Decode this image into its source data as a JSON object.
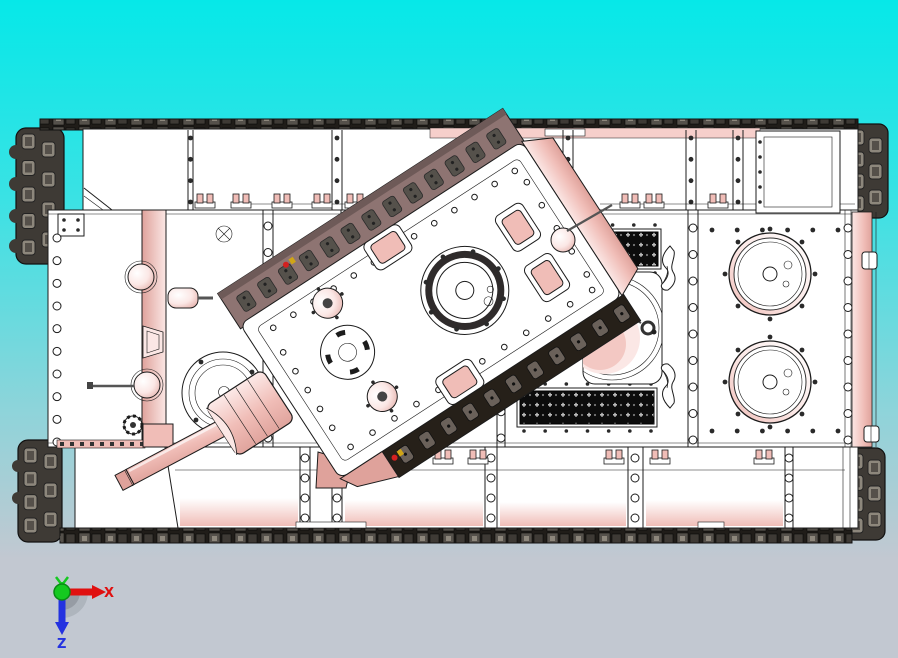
{
  "viewport": {
    "width": 898,
    "height": 658,
    "content": "3D CAD top view of a tank model with rotated turret"
  },
  "triad": {
    "x_label": "X",
    "z_label": "Z"
  },
  "model": {
    "colors": {
      "bg_top": "#06e8e8",
      "bg_upper": "#3ae2e4",
      "bg_lower": "#8dd4da",
      "bg_bottom": "#c2c8d1",
      "outline": "#1c1c1c",
      "hull": "#ffffff",
      "pink": "#f0bdb7",
      "pink_deep": "#dfa29b",
      "pink_pale": "#fbe7e5",
      "mauve": "#8e7472",
      "mauve_dark": "#6e5a58",
      "black_band": "#262019",
      "track": "#3e3a35",
      "track_mid": "#55514b",
      "track_light": "#8d877c",
      "grille": "#0c0c0c",
      "metal_gray": "#8d9096",
      "axis_x": "#e01010",
      "axis_y": "#15c920",
      "axis_z": "#2332e0",
      "detail_red": "#d42020",
      "detail_yellow": "#d0a516"
    }
  }
}
